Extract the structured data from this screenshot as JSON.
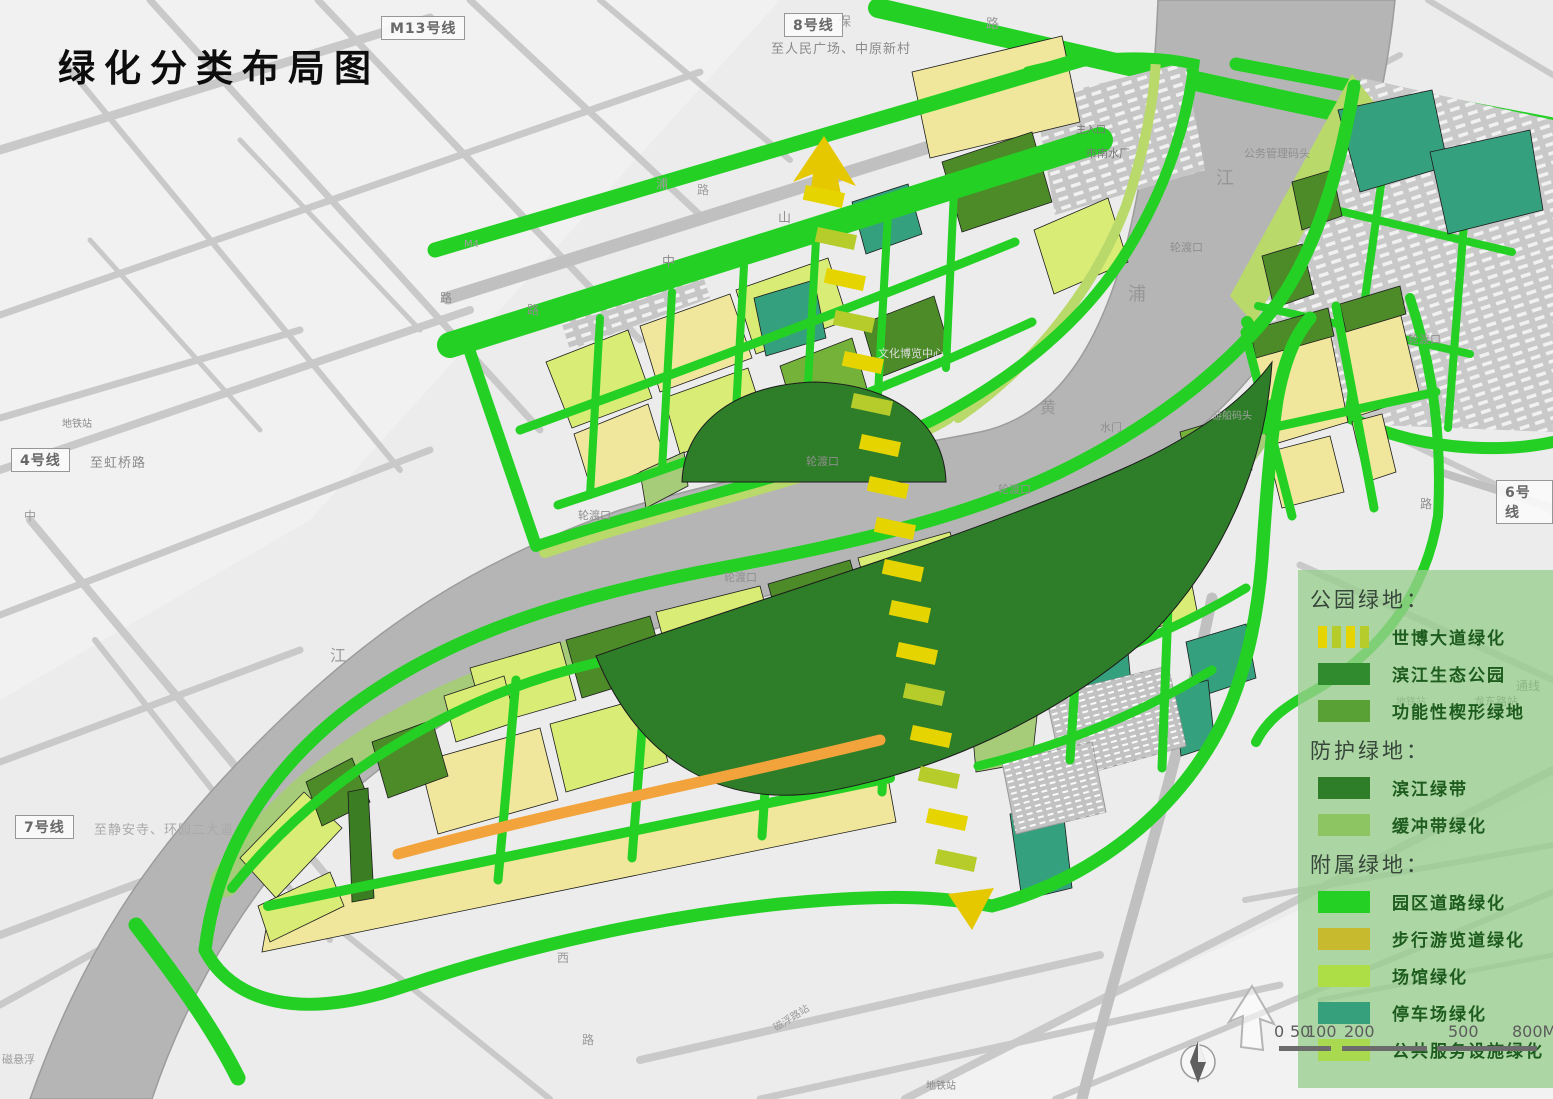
{
  "title": "绿化分类布局图",
  "metro": [
    {
      "label": "M13号线",
      "note": "",
      "box": [
        381,
        16
      ]
    },
    {
      "label": "8号线",
      "note": "至人民广场、中原新村",
      "box": [
        784,
        13
      ],
      "noteXY": [
        771,
        38
      ]
    },
    {
      "label": "4号线",
      "note": "至虹桥路",
      "box": [
        11,
        448
      ],
      "noteXY": [
        90,
        452
      ]
    },
    {
      "label": "7号线",
      "note": "至静安寺、环园二大道",
      "box": [
        15,
        815
      ],
      "noteXY": [
        94,
        819
      ],
      "noteFaint": true
    },
    {
      "label": "6号线",
      "note": "",
      "box": [
        1496,
        480
      ]
    }
  ],
  "map_labels": [
    {
      "text": "保",
      "x": 838,
      "y": 16,
      "s": 13,
      "c": "#9a9a9a"
    },
    {
      "text": "路",
      "x": 986,
      "y": 18,
      "s": 13,
      "c": "#9a9a9a"
    },
    {
      "text": "江",
      "x": 1216,
      "y": 170,
      "s": 18,
      "c": "#969696"
    },
    {
      "text": "浦",
      "x": 1128,
      "y": 286,
      "s": 18,
      "c": "#969696"
    },
    {
      "text": "黄",
      "x": 1040,
      "y": 400,
      "s": 16,
      "c": "#969696"
    },
    {
      "text": "江",
      "x": 330,
      "y": 648,
      "s": 16,
      "c": "#9b9b9b"
    },
    {
      "text": "轮渡口",
      "x": 806,
      "y": 456,
      "s": 11,
      "c": "#8f8f8f"
    },
    {
      "text": "轮渡口",
      "x": 724,
      "y": 572,
      "s": 11,
      "c": "#8f8f8f"
    },
    {
      "text": "轮渡口",
      "x": 998,
      "y": 484,
      "s": 11,
      "c": "#8f8f8f"
    },
    {
      "text": "轮渡口",
      "x": 1170,
      "y": 242,
      "s": 11,
      "c": "#8f8f8f"
    },
    {
      "text": "轮渡口",
      "x": 1408,
      "y": 334,
      "s": 11,
      "c": "#8f8f8f"
    },
    {
      "text": "轮渡口",
      "x": 578,
      "y": 510,
      "s": 11,
      "c": "#8f8f8f"
    },
    {
      "text": "水门",
      "x": 1100,
      "y": 422,
      "s": 11,
      "c": "#8f8f8f"
    },
    {
      "text": "游船码头",
      "x": 1212,
      "y": 412,
      "s": 10,
      "c": "#a2a2a2"
    },
    {
      "text": "文化博览中心",
      "x": 878,
      "y": 348,
      "s": 11,
      "c": "#dedede"
    },
    {
      "text": "主入口",
      "x": 1076,
      "y": 126,
      "s": 10,
      "c": "#787878"
    },
    {
      "text": "市南水厂",
      "x": 1086,
      "y": 148,
      "s": 11,
      "c": "#787878"
    },
    {
      "text": "公务管理码头",
      "x": 1244,
      "y": 148,
      "s": 11,
      "c": "#8f8f8f"
    },
    {
      "text": "通线",
      "x": 1516,
      "y": 680,
      "s": 12,
      "c": "#5f5f5f"
    },
    {
      "text": "龙东路站",
      "x": 1474,
      "y": 696,
      "s": 11,
      "c": "#5f5f5f"
    },
    {
      "text": "地铁站",
      "x": 1396,
      "y": 698,
      "s": 10,
      "c": "#787878"
    },
    {
      "text": "地铁站",
      "x": 62,
      "y": 420,
      "s": 10,
      "c": "#8a8a8a"
    },
    {
      "text": "地铁站",
      "x": 926,
      "y": 1082,
      "s": 10,
      "c": "#8a8a8a"
    },
    {
      "text": "磁浮路站",
      "x": 772,
      "y": 1014,
      "s": 10,
      "c": "#9a9a9a",
      "r": -32
    },
    {
      "text": "M4",
      "x": 464,
      "y": 240,
      "s": 10,
      "c": "#9e9e9e"
    },
    {
      "text": "山",
      "x": 778,
      "y": 212,
      "s": 13,
      "c": "#8f8f8f"
    },
    {
      "text": "中",
      "x": 662,
      "y": 256,
      "s": 13,
      "c": "#8f8f8f"
    },
    {
      "text": "路",
      "x": 527,
      "y": 304,
      "s": 12,
      "c": "#8f8f8f"
    },
    {
      "text": "路",
      "x": 440,
      "y": 292,
      "s": 12,
      "c": "#8f8f8f"
    },
    {
      "text": "浦",
      "x": 656,
      "y": 178,
      "s": 12,
      "c": "#9e9e9e"
    },
    {
      "text": "路",
      "x": 697,
      "y": 184,
      "s": 12,
      "c": "#9e9e9e"
    },
    {
      "text": "中",
      "x": 24,
      "y": 510,
      "s": 12,
      "c": "#9a9a9a"
    },
    {
      "text": "西",
      "x": 557,
      "y": 952,
      "s": 12,
      "c": "#9a9a9a"
    },
    {
      "text": "路",
      "x": 582,
      "y": 1034,
      "s": 12,
      "c": "#9a9a9a"
    },
    {
      "text": "磁悬浮",
      "x": 2,
      "y": 1054,
      "s": 11,
      "c": "#9a9a9a"
    },
    {
      "text": "路",
      "x": 1420,
      "y": 498,
      "s": 12,
      "c": "#8f8f8f"
    }
  ],
  "legend": {
    "groups": [
      {
        "header": "公园绿地：",
        "items": [
          {
            "label": "世博大道绿化",
            "swatch": "dashed"
          },
          {
            "label": "滨江生态公园",
            "swatch": "#2f8b2d"
          },
          {
            "label": "功能性楔形绿地",
            "swatch": "#59a134"
          }
        ]
      },
      {
        "header": "防护绿地：",
        "items": [
          {
            "label": "滨江绿带",
            "swatch": "#2e7d28"
          },
          {
            "label": "缓冲带绿化",
            "swatch": "#8cc561"
          }
        ]
      },
      {
        "header": "附属绿地：",
        "items": [
          {
            "label": "园区道路绿化",
            "swatch": "#25d025"
          },
          {
            "label": "步行游览道绿化",
            "swatch": "#c8ba2e"
          },
          {
            "label": "场馆绿化",
            "swatch": "#aede46"
          },
          {
            "label": "停车场绿化",
            "swatch": "#36a07c"
          },
          {
            "label": "公共服务设施绿化",
            "swatch": "#a9d94e"
          }
        ]
      }
    ]
  },
  "scale": {
    "ticks": [
      {
        "label": "0",
        "x": 1274
      },
      {
        "label": "50",
        "x": 1290
      },
      {
        "label": "100",
        "x": 1306
      },
      {
        "label": "200",
        "x": 1344
      },
      {
        "label": "500",
        "x": 1448
      },
      {
        "label": "800M",
        "x": 1512
      }
    ]
  },
  "colors": {
    "road_green": "#25d025",
    "park_dark_green": "#2e7d28",
    "wedge_green": "#59a134",
    "buffer_green": "#a6cc7a",
    "venue_yellow_green": "#d9ec76",
    "pale_yellow": "#f0e79c",
    "parking_teal": "#35a07e",
    "walkway_orange": "#f2a33c",
    "dash_yellow": "#e5d400",
    "dash_green": "#b5cc2a",
    "river_gray": "#b5b5b5"
  }
}
